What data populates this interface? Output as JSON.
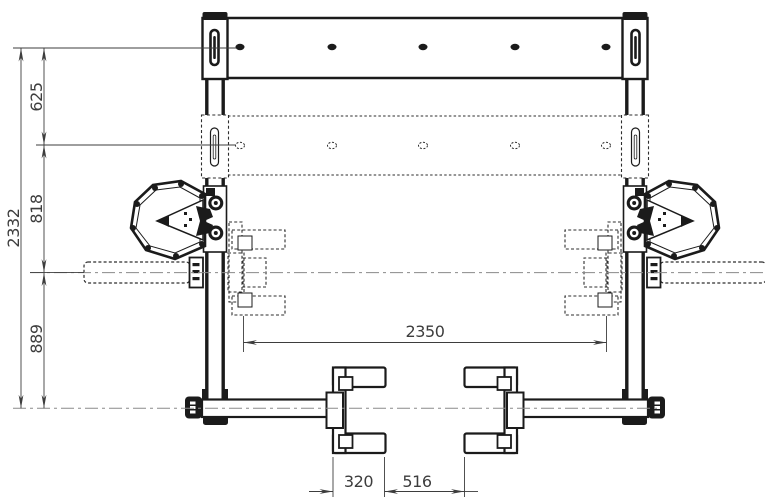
{
  "drawing": {
    "type": "engineering-front-view",
    "dimensions": {
      "overall_height": "2332",
      "top_offset": "625",
      "mid_offset": "818",
      "axle_height": "889",
      "inner_width": "2350",
      "bracket_width": "320",
      "bracket_gap": "516"
    },
    "colors": {
      "background": "#ffffff",
      "structure_line": "#1b1b1b",
      "dimension_line": "#3d3d3d",
      "phantom_line": "#2e2e2e",
      "centerline": "#8a8a8a"
    }
  }
}
